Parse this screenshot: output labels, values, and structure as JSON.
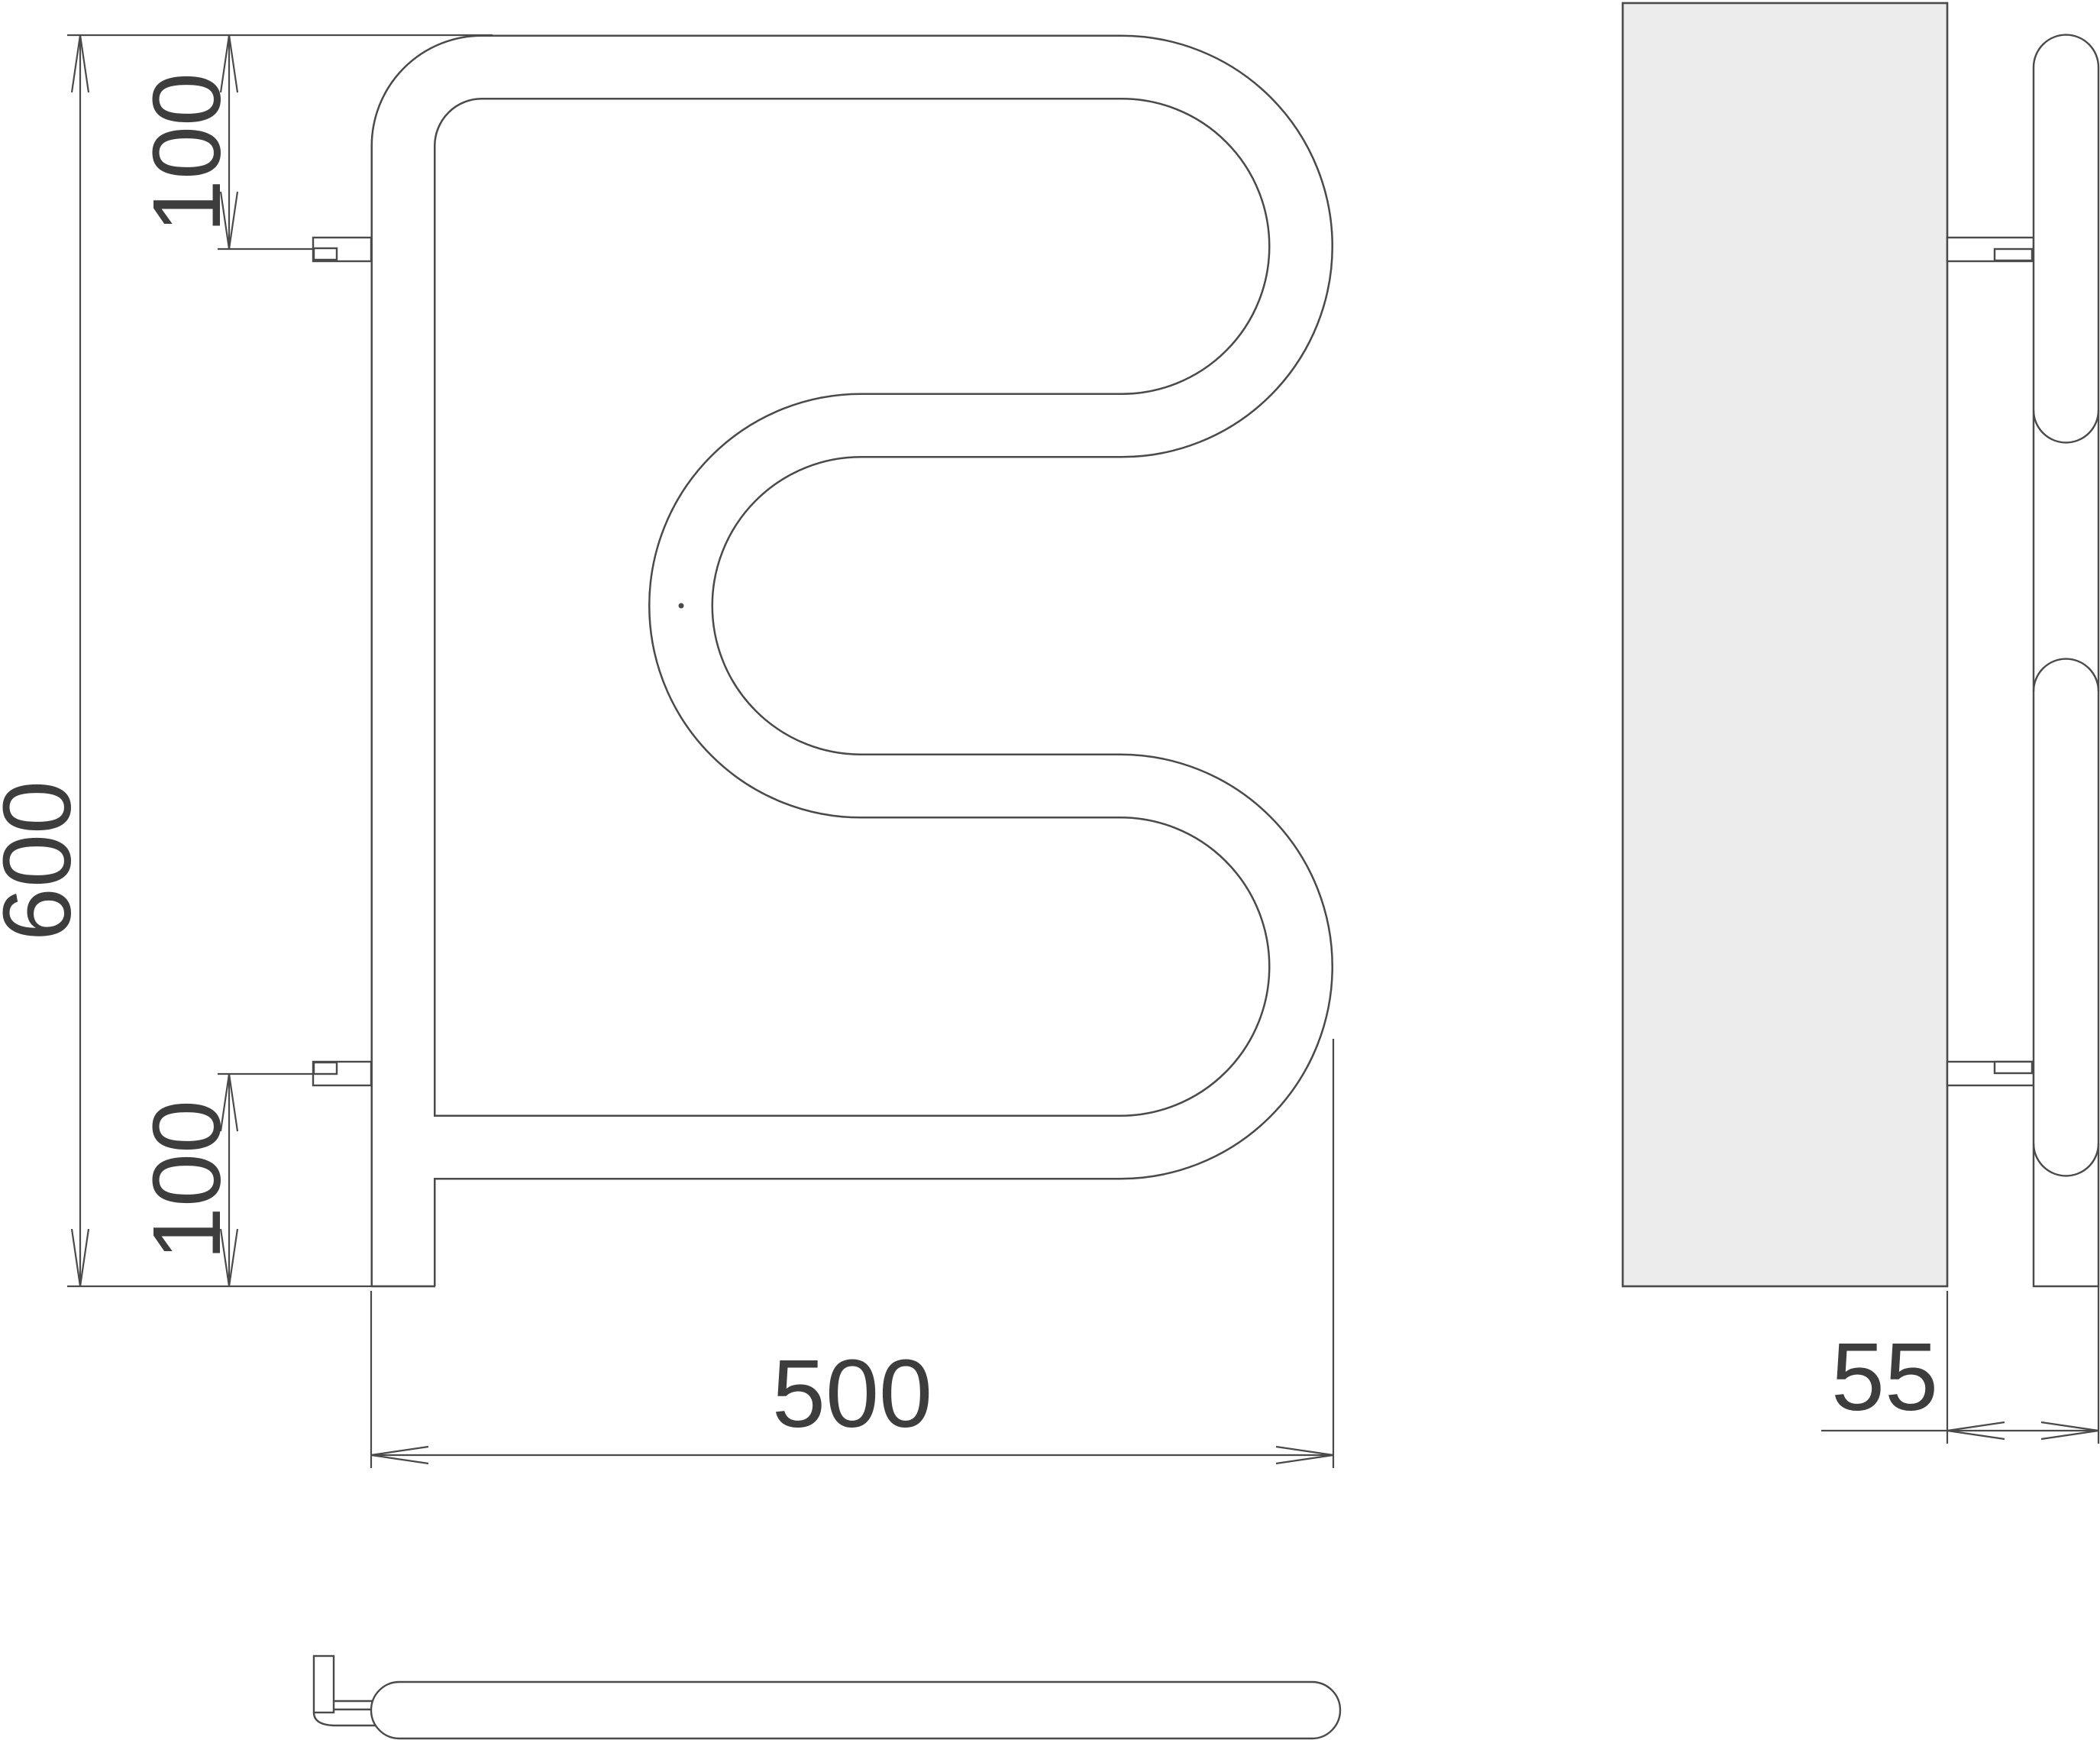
{
  "drawing": {
    "kind": "towel-rail-technical-drawing",
    "views": {
      "front_view": {
        "dim_height": "600",
        "dim_top_bracket_offset": "100",
        "dim_bottom_bracket_offset": "100",
        "dim_width": "500"
      },
      "side_view": {
        "dim_wall_to_tube": "55"
      }
    }
  },
  "theme": {
    "line": "#4a4a4a",
    "text": "#3d3d3d",
    "panel_fill": "#ececec",
    "tube_fill": "#ffffff",
    "background": "#ffffff"
  }
}
